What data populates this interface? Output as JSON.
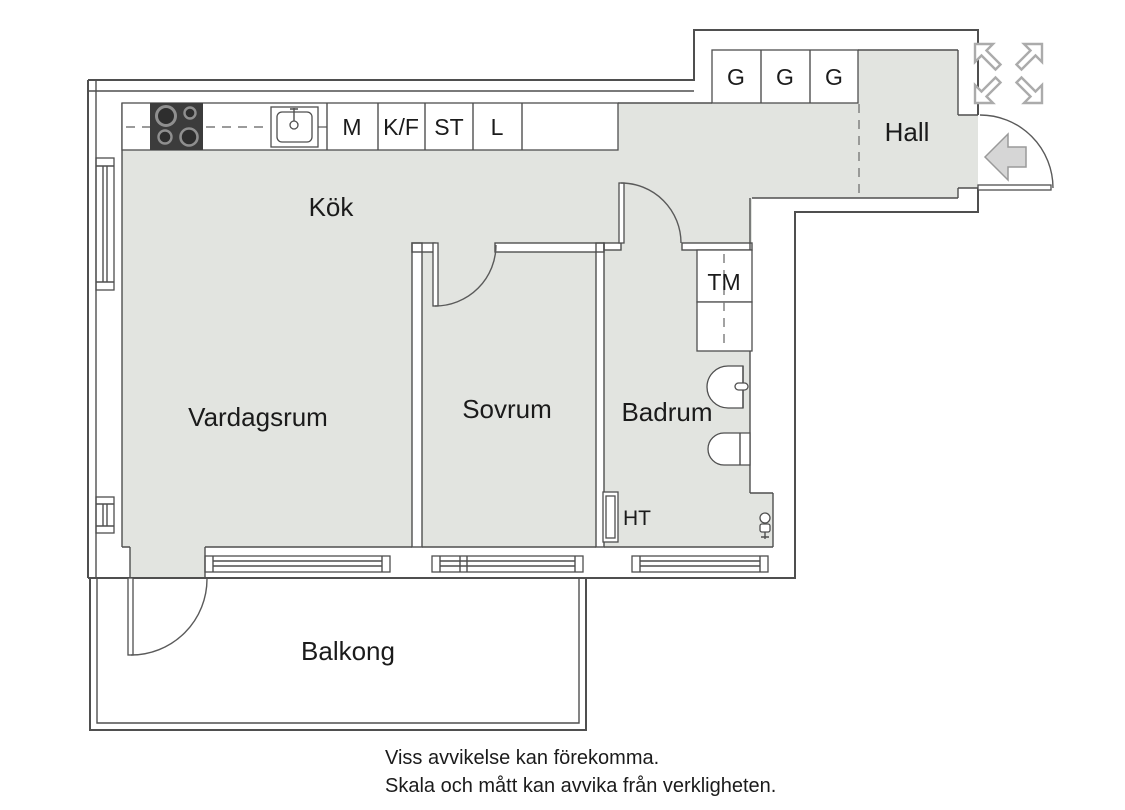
{
  "plan": {
    "rooms": {
      "kitchen": "Kök",
      "living_room": "Vardagsrum",
      "bedroom": "Sovrum",
      "bathroom": "Badrum",
      "hall": "Hall",
      "balcony": "Balkong"
    },
    "kitchen_units": [
      "M",
      "K/F",
      "ST",
      "L"
    ],
    "closets": [
      "G",
      "G",
      "G"
    ],
    "appliances": {
      "washing_machine": "TM",
      "towel_dryer": "HT"
    },
    "colors": {
      "floor": "#e2e4e0",
      "wall_line": "#4f4f4f",
      "stove": "#3c3c3c",
      "symbol_gray": "#ababab",
      "entry_arrow_fill": "#d6d6d6",
      "text": "#1b1b1b"
    }
  },
  "footer": {
    "line1": "Viss avvikelse kan förekomma.",
    "line2": "Skala och mått kan avvika från verkligheten."
  }
}
